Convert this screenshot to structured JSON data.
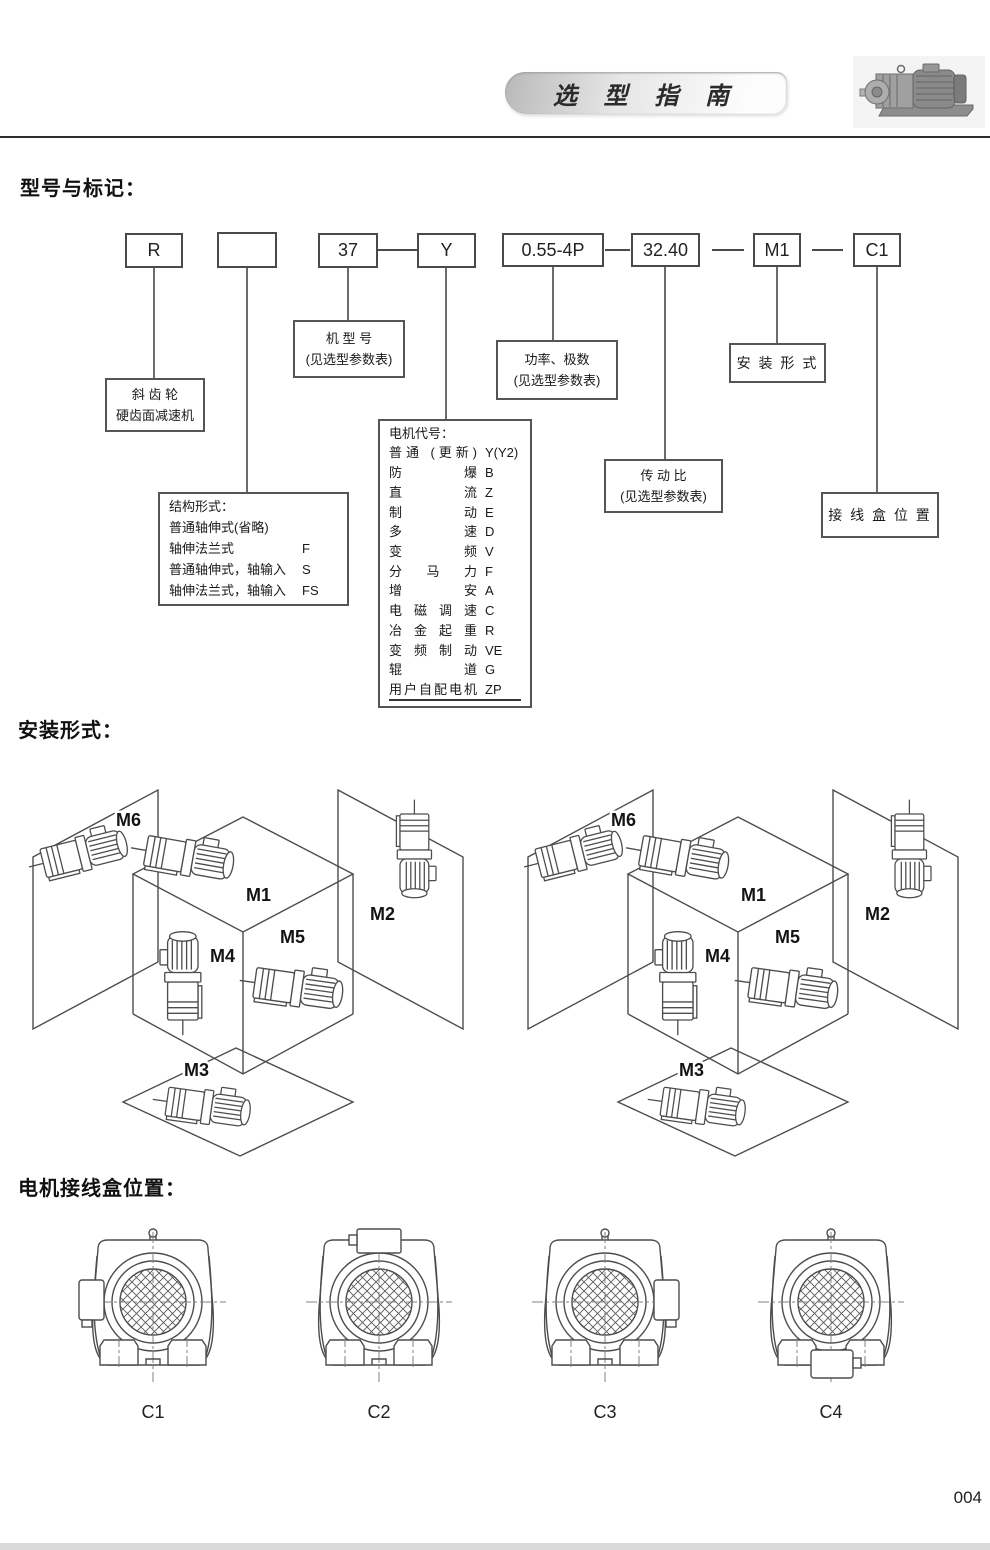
{
  "header": {
    "title": "选 型 指 南"
  },
  "page": {
    "number": "004"
  },
  "sections": {
    "model_marking": "型号与标记：",
    "mounting": "安装形式：",
    "junction": "电机接线盒位置："
  },
  "model_code": {
    "boxes": [
      "R",
      "",
      "37",
      "Y",
      "0.55-4P",
      "32.40",
      "M1",
      "C1"
    ]
  },
  "callouts": {
    "reducer_line1": "斜 齿 轮",
    "reducer_line2": "硬齿面减速机",
    "model_no_line1": "机 型 号",
    "model_no_line2": "(见选型参数表)",
    "structure": {
      "title": "结构形式：",
      "rows": [
        {
          "label": "普通轴伸式(省略)",
          "code": ""
        },
        {
          "label": "轴伸法兰式",
          "code": "F"
        },
        {
          "label": "普通轴伸式，轴输入",
          "code": "S"
        },
        {
          "label": "轴伸法兰式，轴输入",
          "code": "FS"
        }
      ]
    },
    "motor_code": {
      "title": "电机代号：",
      "rows": [
        {
          "label": "普通 (更新)",
          "code": "Y(Y2)"
        },
        {
          "label": "防爆",
          "code": "B"
        },
        {
          "label": "直流",
          "code": "Z"
        },
        {
          "label": "制动",
          "code": "E"
        },
        {
          "label": "多速",
          "code": "D"
        },
        {
          "label": "变频",
          "code": "V"
        },
        {
          "label": "分马力",
          "code": "F"
        },
        {
          "label": "增安",
          "code": "A"
        },
        {
          "label": "电磁调速",
          "code": "C"
        },
        {
          "label": "冶金起重",
          "code": "R"
        },
        {
          "label": "变频制动",
          "code": "VE"
        },
        {
          "label": "辊道",
          "code": "G"
        },
        {
          "label": "用户自配电机",
          "code": "ZP"
        }
      ]
    },
    "power_line1": "功率、极数",
    "power_line2": "(见选型参数表)",
    "ratio_line1": "传 动 比",
    "ratio_line2": "(见选型参数表)",
    "mounting_form": "安 装 形 式",
    "jbox_position": "接 线 盒 位 置"
  },
  "mounting": {
    "labels": [
      "M1",
      "M2",
      "M3",
      "M4",
      "M5",
      "M6"
    ]
  },
  "junction": {
    "items": [
      {
        "label": "C1",
        "position": "left"
      },
      {
        "label": "C2",
        "position": "top"
      },
      {
        "label": "C3",
        "position": "right"
      },
      {
        "label": "C4",
        "position": "bottom"
      }
    ]
  }
}
